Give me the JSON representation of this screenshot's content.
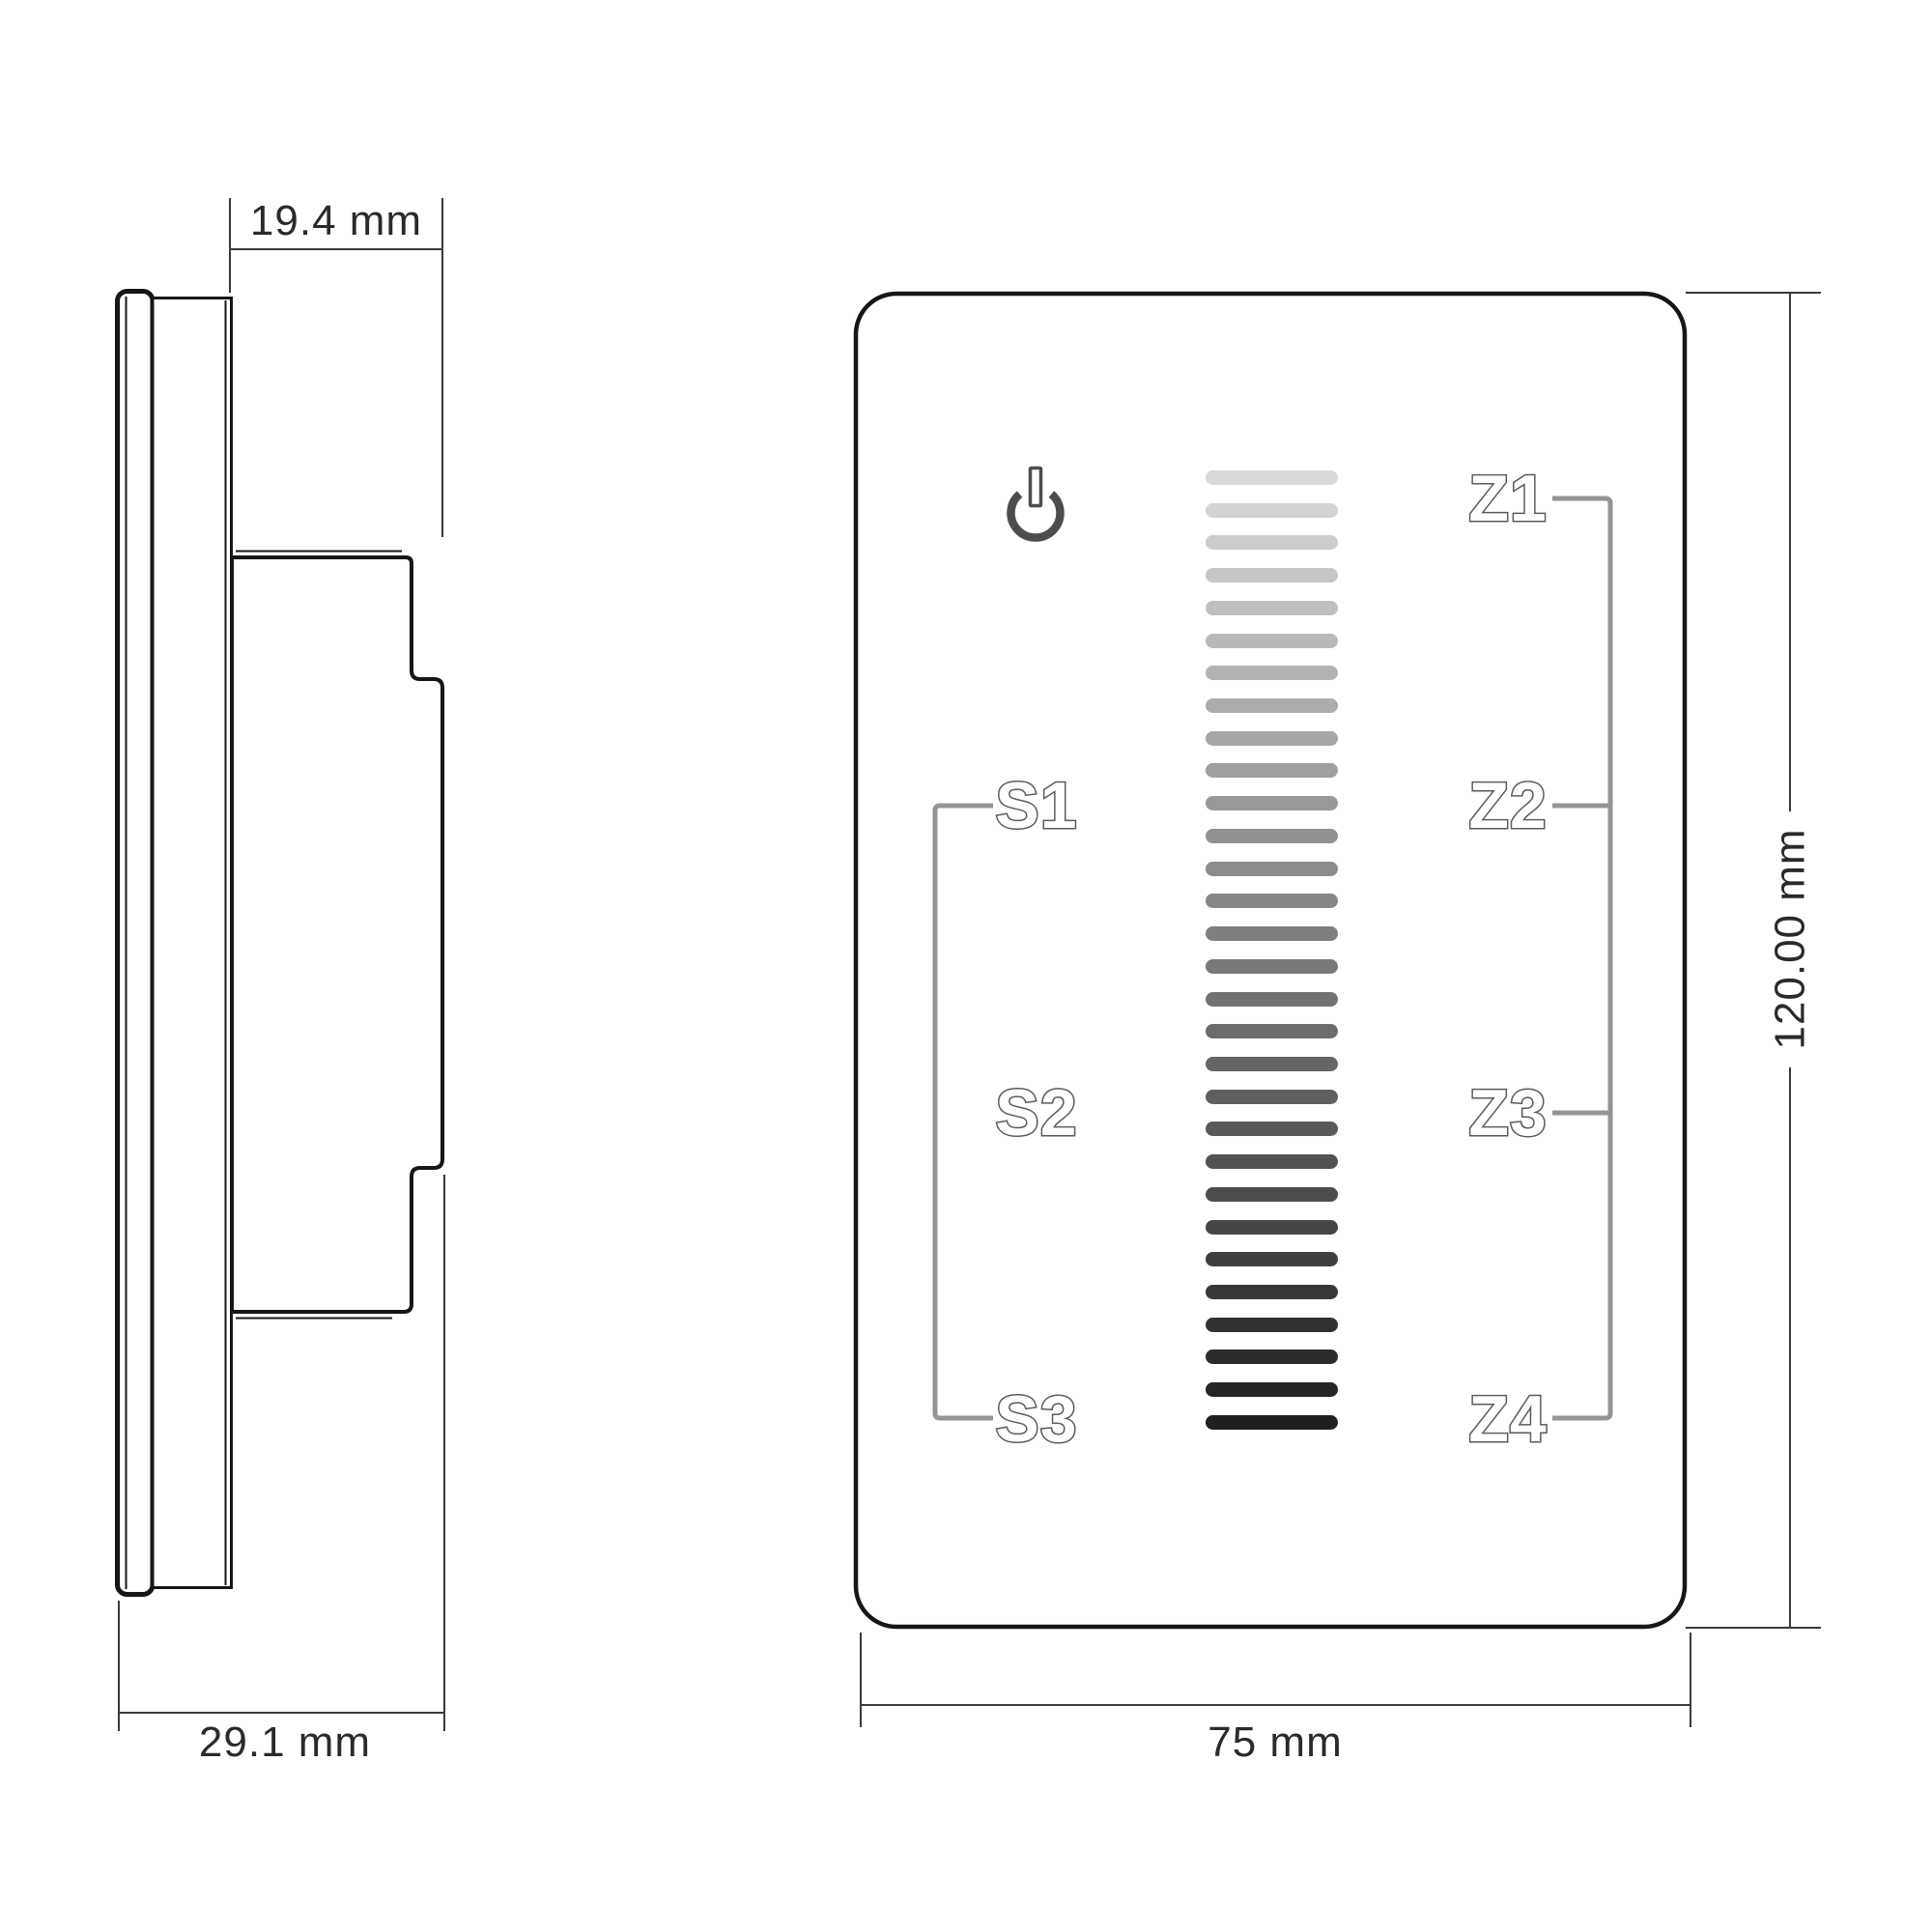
{
  "drawing": {
    "side_view": {
      "dim_depth_front": "19.4 mm",
      "dim_depth_total": "29.1 mm"
    },
    "front_view": {
      "dim_width": "75 mm",
      "dim_height": "120.00 mm",
      "scene_buttons": [
        "S1",
        "S2",
        "S3"
      ],
      "zone_buttons": [
        "Z1",
        "Z2",
        "Z3",
        "Z4"
      ],
      "slider": {
        "bar_count": 30,
        "color_top": "#d9d9d9",
        "color_bottom": "#1f1f1f"
      }
    },
    "colors": {
      "outline": "#161616",
      "bracket": "#949494",
      "label_outline": "#5a5a5a",
      "icon": "#4d4d4d",
      "dim_line": "#3a3a3a",
      "dim_text": "#2a2a2a"
    }
  }
}
